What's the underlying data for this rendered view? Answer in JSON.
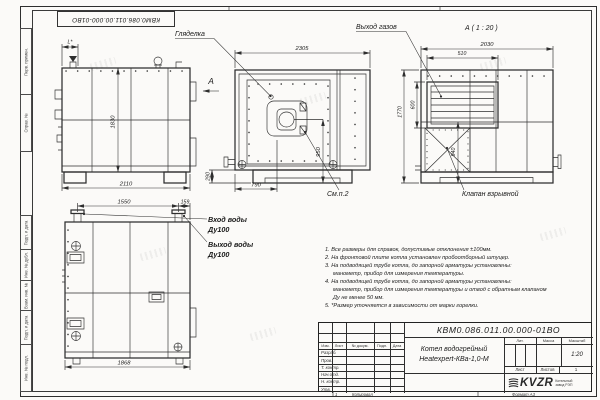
{
  "colors": {
    "line": "#2e2e2e",
    "paper": "#fbfaf8",
    "text": "#1a1a1a"
  },
  "stamp_top": {
    "text": "КВМ0.086.011.00.000-01ВО"
  },
  "frame": {
    "left_labels": [
      "Перв. примен.",
      "Справ. №",
      "Подп. и дата",
      "Инв. № дубл.",
      "Взам. инв. №",
      "Подп. и дата",
      "Инв. № подл."
    ],
    "bottom": {
      "zone": "1",
      "copied": "Копировал",
      "format": "Формат А3"
    }
  },
  "views": {
    "side_left": {
      "view_arrow": "А",
      "dims": {
        "top_offset": "L*",
        "height": "1830",
        "width": "2110"
      }
    },
    "front": {
      "sight_glass_label": "Гляделка",
      "see_note_label": "См.п.2",
      "dims": {
        "width": "2305",
        "burner_axis": "950",
        "burner_offset": "790",
        "base_height": "290"
      }
    },
    "view_a": {
      "title": "А ( 1 : 20 )",
      "gas_outlet_label": "Выход газов",
      "valve_label": "Клапан взрывной",
      "dims": {
        "width": "2030",
        "vent_width": "510",
        "vent_height": "600",
        "height": "1770",
        "valve_axis": "940"
      }
    },
    "side_bottom": {
      "inlet_label": "Вход воды",
      "inlet_dn": "Ду100",
      "outlet_label": "Выход воды",
      "outlet_dn": "Ду100",
      "dims": {
        "pipe_span": "1550",
        "pipe_offset": "159",
        "width": "1868"
      }
    }
  },
  "notes": {
    "lines": [
      "1. Все размеры для справок, допустимые отклонения ±100мм.",
      "2. На фронтовой плите котла установлен пробоотборный штуцер.",
      "3. На подводящей трубе котла, до запорной арматуры установлены:",
      "манометр, прибор для измерения температуры.",
      "4. На подводящей трубе котла, до запорной арматуры установлены:",
      "манометр, прибор для измерения температуры и отвод с обратным клапаном",
      "Ду не менее 50 мм.",
      "5. *Размер уточняется в зависимости от марки горелки."
    ]
  },
  "title_block": {
    "designation": "КВМ0.086.011.00.000-01ВО",
    "product_name_1": "Котел водогрейный",
    "product_name_2": "Heatexpert-КВа-1,0-М",
    "cols": [
      "Изм.",
      "Лист",
      "№ докум.",
      "Подп.",
      "Дата"
    ],
    "rows": [
      "Разраб.",
      "Пров.",
      "Т. контр.",
      "Нач.отд.",
      "Н. контр.",
      "Утв."
    ],
    "lit_label": "Лит.",
    "mass_label": "Масса",
    "scale_label": "Масштаб",
    "scale_value": "1:20",
    "sheet_label": "Лист",
    "sheets_label": "Листов",
    "sheets_value": "1",
    "logo_text": "KVZR",
    "logo_caption_1": "Котельный",
    "logo_caption_2": "завод РЭП"
  }
}
